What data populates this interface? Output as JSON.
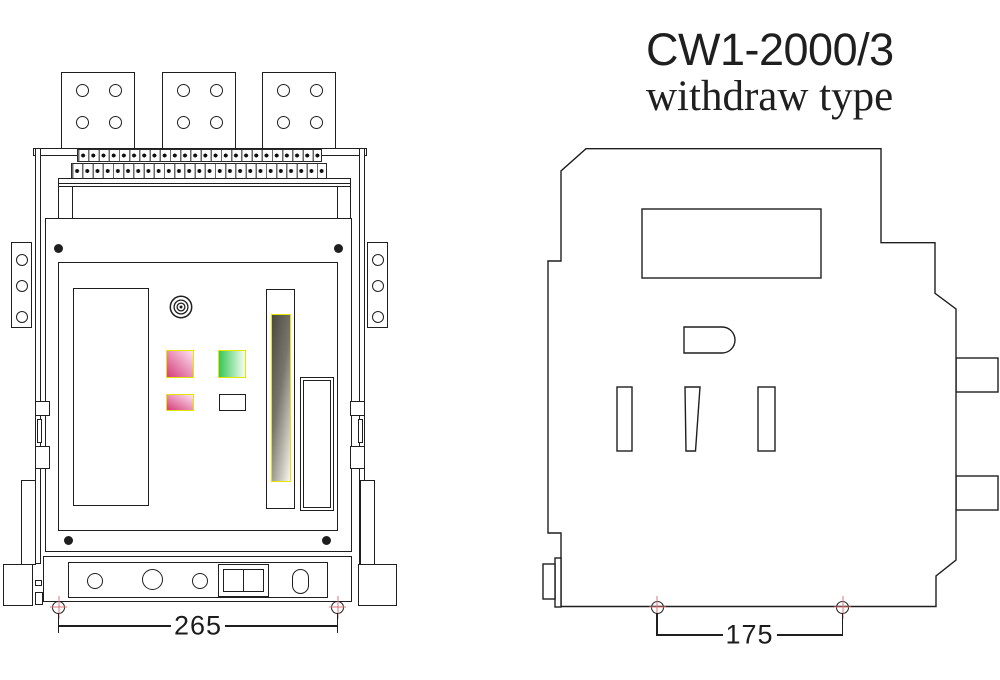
{
  "title": {
    "model": "CW1-2000/3",
    "type_label": "withdraw type"
  },
  "front_view": {
    "dimension_label": "265"
  },
  "side_view": {
    "dimension_label": "175"
  },
  "icons": {
    "key_lock_icon": "concentric-circles",
    "center_mark_icon": "red-cross-circle"
  },
  "colors": {
    "line": "#1f1f1f",
    "marker_red": "#dd7a7a",
    "button_yellow": "#e4e600",
    "pink_dark": "#d84a85",
    "pink_light": "#fbdcec",
    "green_dark": "#3ec95e",
    "green_light": "#eefcee"
  }
}
